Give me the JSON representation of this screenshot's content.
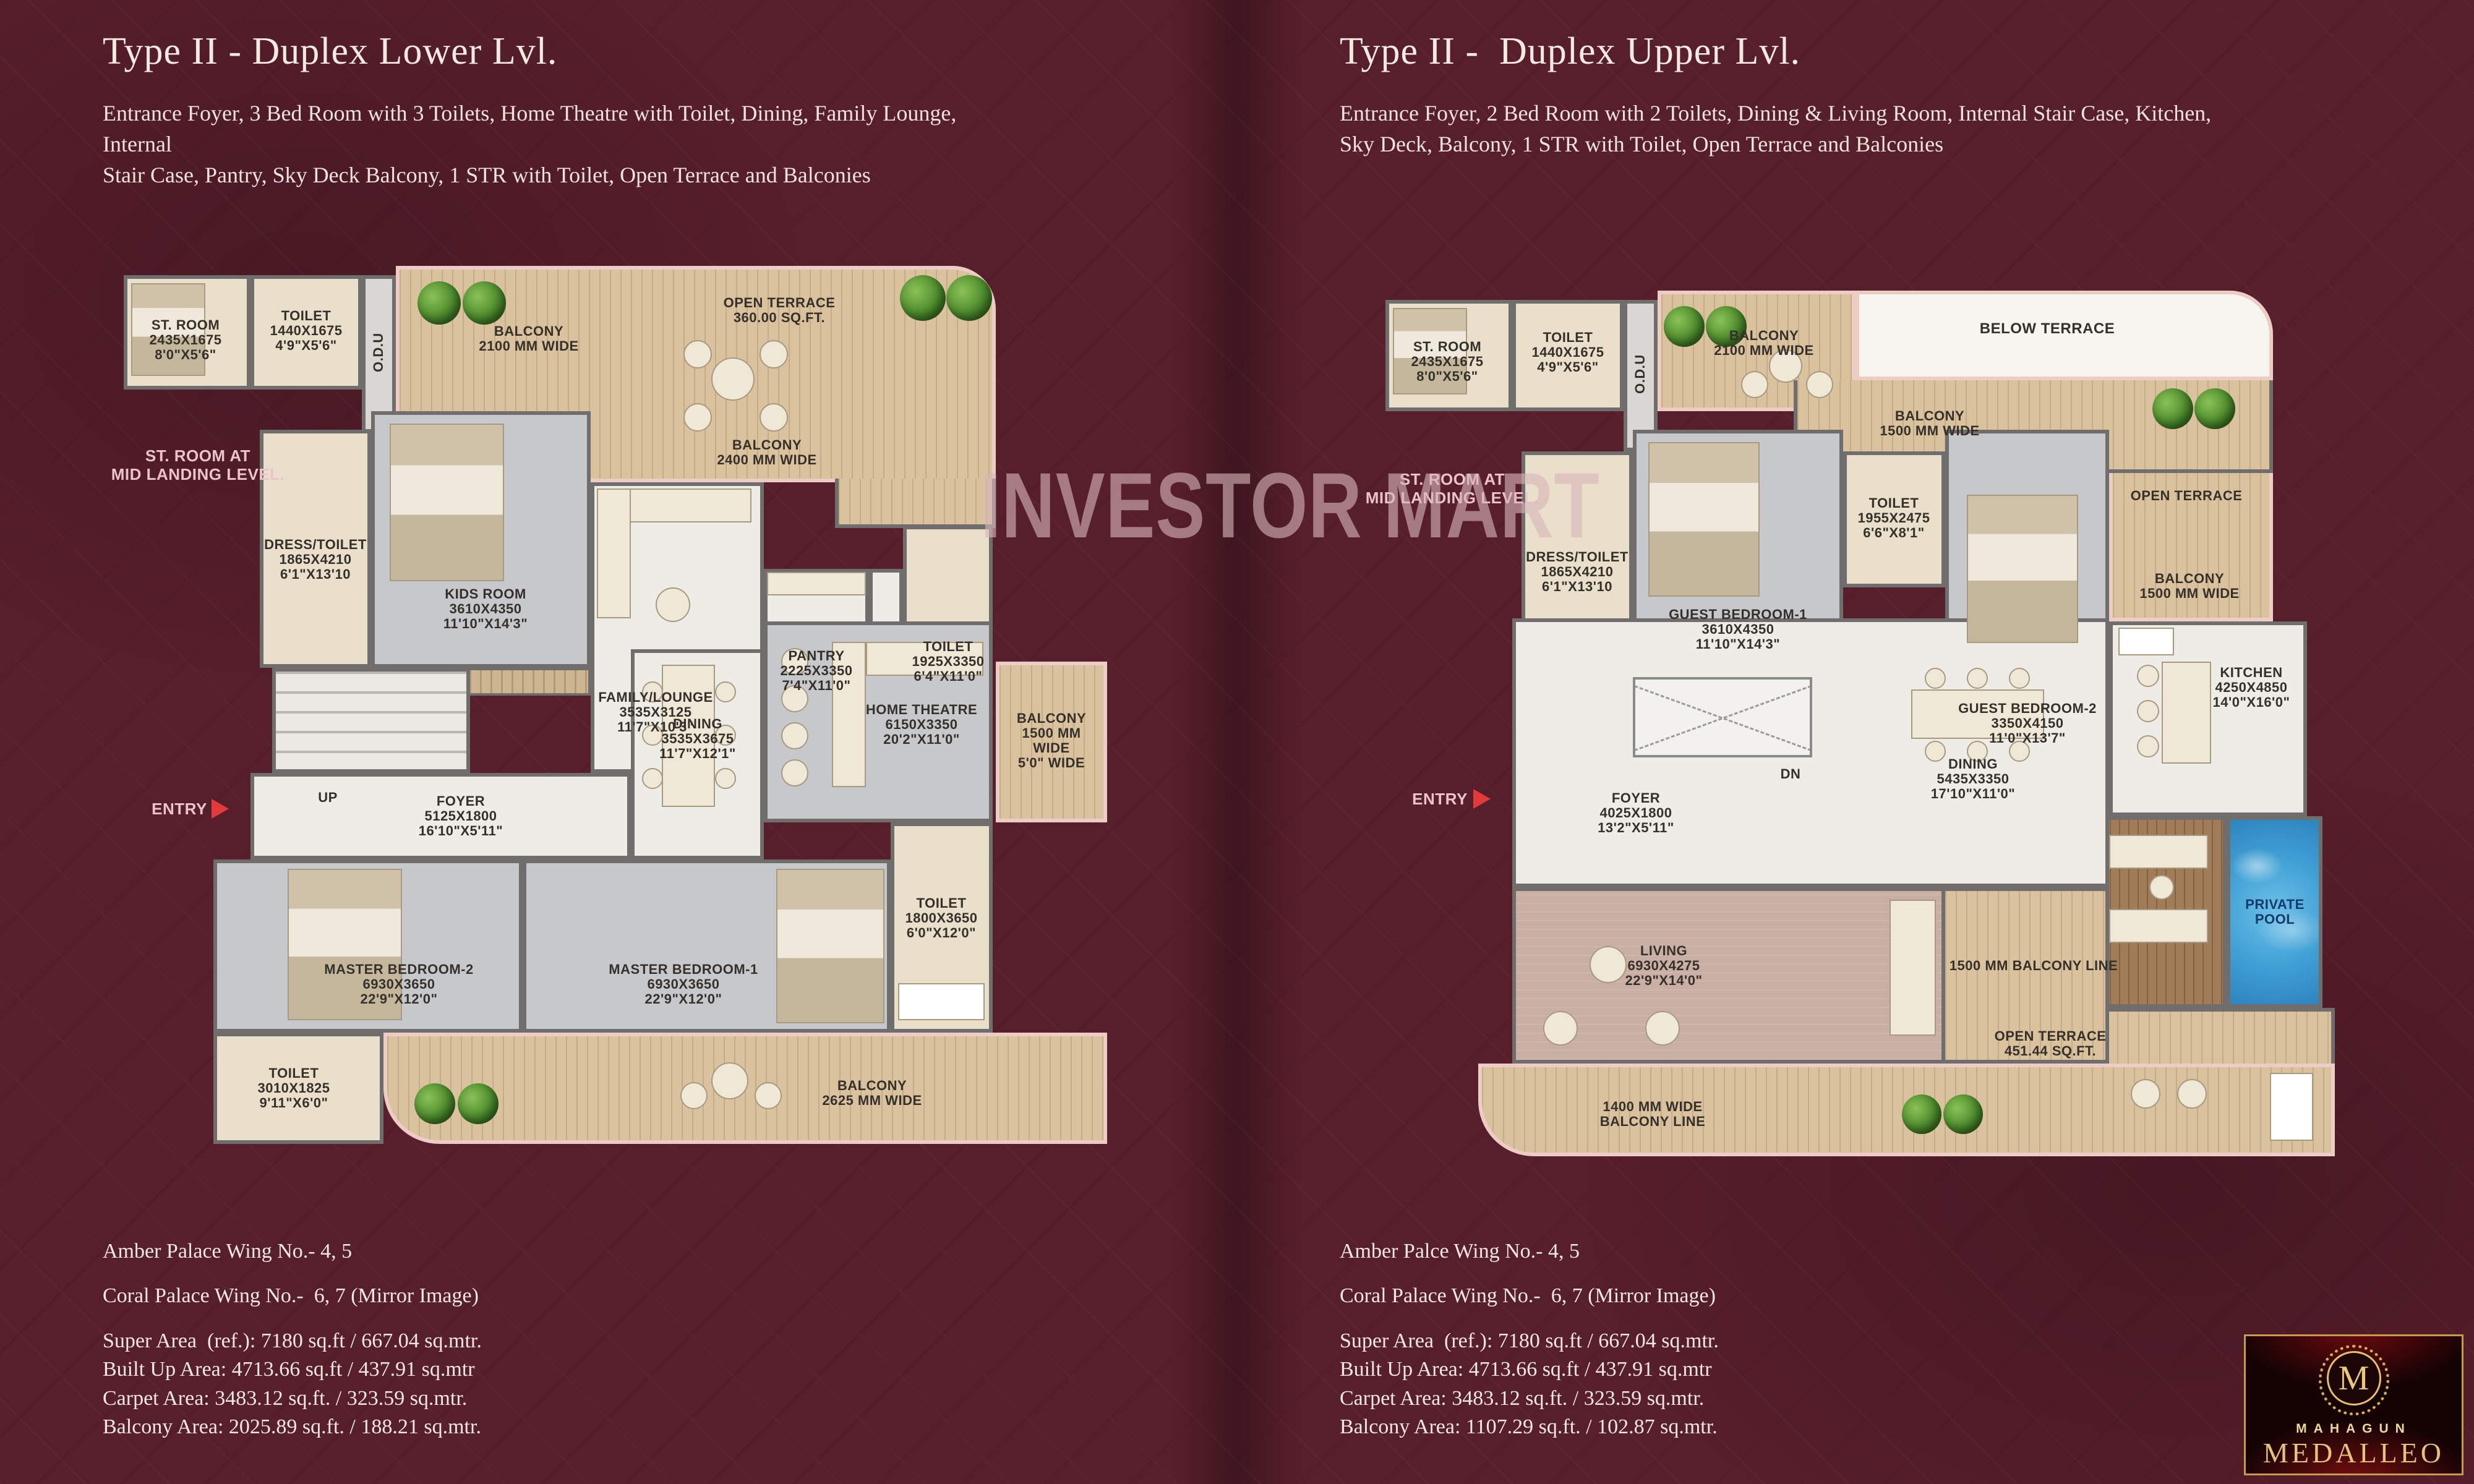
{
  "watermark": "INVESTOR MART",
  "colors": {
    "background": "#571e2b",
    "wall": "#6f6e6c",
    "wood_deck": "#d9c29d",
    "pool_blue": "#3f9fd4",
    "entry_arrow": "#e23b3b",
    "gold": "#d9ab52"
  },
  "left_panel": {
    "title": "Type II - Duplex Lower Lvl.",
    "description": "Entrance Foyer, 3 Bed Room with 3 Toilets, Home Theatre with Toilet, Dining, Family Lounge, Internal\nStair Case, Pantry, Sky Deck Balcony, 1 STR with Toilet, Open Terrace and Balconies",
    "labels": {
      "st_room": "ST. ROOM\n2435X1675\n8'0\"X5'6\"",
      "toilet_top": "TOILET\n1440X1675\n4'9\"X5'6\"",
      "odu": "O.D.U",
      "balcony_2100": "BALCONY\n2100 MM WIDE",
      "open_terrace": "OPEN TERRACE\n360.00 SQ.FT.",
      "balcony_2400": "BALCONY\n2400 MM WIDE",
      "st_room_mid": "ST. ROOM AT\nMID LANDING LEVEL.",
      "dress_toilet": "DRESS/TOILET\n1865X4210\n6'1\"X13'10",
      "kids_room": "KIDS ROOM\n3610X4350\n11'10\"X14'3\"",
      "family_lounge": "FAMILY/LOUNGE\n3535X3125\n11'7\"X10'3\"",
      "pantry": "PANTRY\n2225X3350\n7'4\"X11'0\"",
      "toilet_mid": "TOILET\n1925X3350\n6'4\"X11'0\"",
      "balcony_1500": "BALCONY\n1500 MM WIDE\n5'0\" WIDE",
      "up": "UP",
      "foyer": "FOYER\n5125X1800\n16'10\"X5'11\"",
      "dining": "DINING\n3535X3675\n11'7\"X12'1\"",
      "home_theatre": "HOME THEATRE\n6150X3350\n20'2\"X11'0\"",
      "entry": "ENTRY",
      "master_bedroom_2": "MASTER BEDROOM-2\n6930X3650\n22'9\"X12'0\"",
      "master_bedroom_1": "MASTER BEDROOM-1\n6930X3650\n22'9\"X12'0\"",
      "toilet_mb2": "TOILET\n3010X1825\n9'11\"X6'0\"",
      "toilet_mb1": "TOILET\n1800X3650\n6'0\"X12'0\"",
      "balcony_2625": "BALCONY\n2625 MM WIDE"
    },
    "footer": {
      "wing1": "Amber Palace Wing No.- 4, 5",
      "wing2": "Coral Palace Wing No.-  6, 7 (Mirror Image)",
      "area1": "Super Area  (ref.): 7180 sq.ft / 667.04 sq.mtr.",
      "area2": "Built Up Area: 4713.66 sq.ft / 437.91 sq.mtr",
      "area3": "Carpet Area: 3483.12 sq.ft. / 323.59 sq.mtr.",
      "area4": "Balcony Area: 2025.89 sq.ft. / 188.21 sq.mtr."
    }
  },
  "right_panel": {
    "title": "Type II -  Duplex Upper Lvl.",
    "description": "Entrance Foyer, 2 Bed Room with 2 Toilets, Dining & Living Room, Internal Stair Case, Kitchen,\nSky Deck, Balcony, 1 STR with Toilet, Open Terrace and Balconies",
    "labels": {
      "st_room": "ST. ROOM\n2435X1675\n8'0\"X5'6\"",
      "toilet_top": "TOILET\n1440X1675\n4'9\"X5'6\"",
      "odu": "O.D.U",
      "balcony_2100": "BALCONY\n2100 MM WIDE",
      "below_terrace": "BELOW TERRACE",
      "balcony_1500_top": "BALCONY\n1500 MM WIDE",
      "open_terrace_right": "OPEN TERRACE",
      "balcony_1500_right": "BALCONY\n1500 MM WIDE",
      "st_room_mid": "ST. ROOM AT\nMID LANDING LEVEL.",
      "dress_toilet": "DRESS/TOILET\n1865X4210\n6'1\"X13'10",
      "guest_bedroom_1": "GUEST BEDROOM-1\n3610X4350\n11'10\"X14'3\"",
      "toilet_gb": "TOILET\n1955X2475\n6'6\"X8'1\"",
      "guest_bedroom_2": "GUEST BEDROOM-2\n3350X4150\n11'0\"X13'7\"",
      "kitchen": "KITCHEN\n4250X4850\n14'0\"X16'0\"",
      "dn": "DN",
      "foyer": "FOYER\n4025X1800\n13'2\"X5'11\"",
      "dining": "DINING\n5435X3350\n17'10\"X11'0\"",
      "entry": "ENTRY",
      "living": "LIVING\n6930X4275\n22'9\"X14'0\"",
      "balcony_line_1500": "1500 MM BALCONY LINE",
      "private_pool": "PRIVATE POOL",
      "open_terrace_bottom": "OPEN TERRACE\n451.44 SQ.FT.",
      "balcony_line_1400": "1400 MM WIDE\nBALCONY LINE"
    },
    "footer": {
      "wing1": "Amber Palce Wing No.- 4, 5",
      "wing2": "Coral Palace Wing No.-  6, 7 (Mirror Image)",
      "area1": "Super Area  (ref.): 7180 sq.ft / 667.04 sq.mtr.",
      "area2": "Built Up Area: 4713.66 sq.ft / 437.91 sq.mtr",
      "area3": "Carpet Area: 3483.12 sq.ft. / 323.59 sq.mtr.",
      "area4": "Balcony Area: 1107.29 sq.ft. / 102.87 sq.mtr."
    }
  },
  "logo": {
    "brand": "MAHAGUN",
    "name": "MEDALLEO",
    "monogram": "M"
  }
}
